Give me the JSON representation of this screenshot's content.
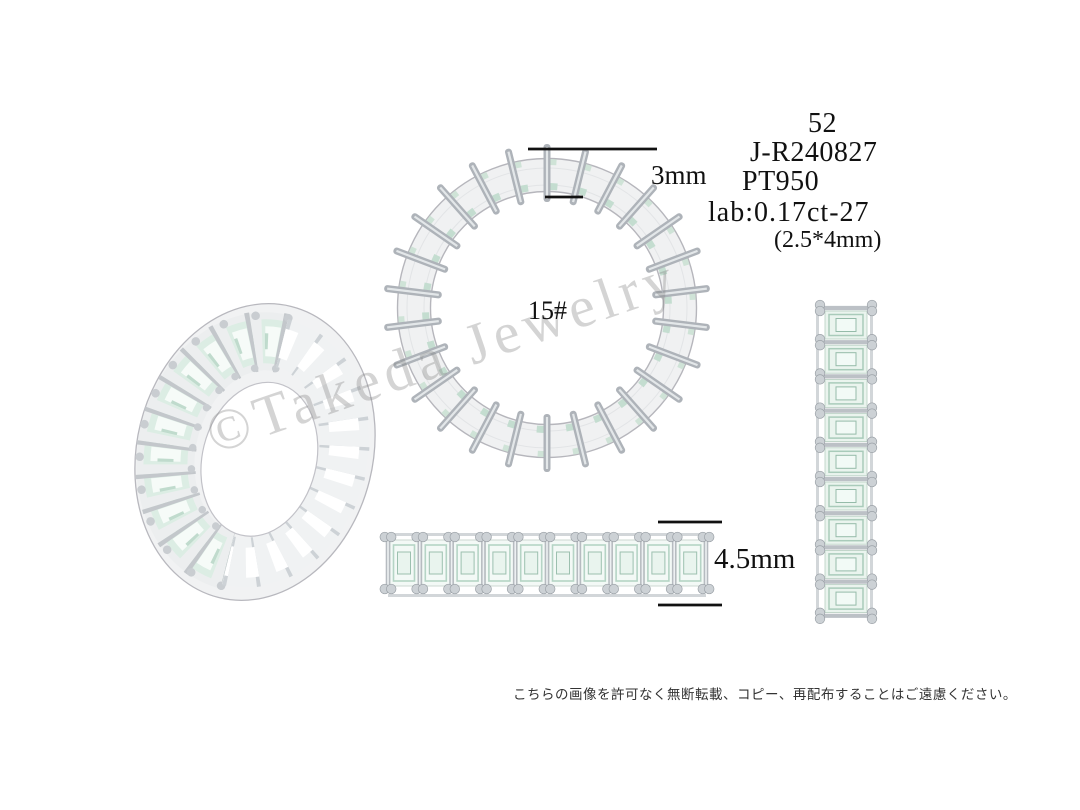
{
  "specs": {
    "size": "52",
    "model_number": "J-R240827",
    "metal": "PT950",
    "stone_spec": "lab:0.17ct-27",
    "stone_size": "(2.5*4mm)"
  },
  "dimensions": {
    "band_width": "3mm",
    "band_height": "4.5mm"
  },
  "ring": {
    "size_label": "15#"
  },
  "watermark": {
    "text": "©Takeda Jewelry",
    "color": "#c9c9c9"
  },
  "footer": {
    "disclaimer": "こちらの画像を許可なく無断転載、コピー、再配布することはご遠慮ください。"
  },
  "colors": {
    "metal_light": "#f1f2f3",
    "metal_mid": "#b4b8bd",
    "metal_outline": "#b6b6bc",
    "stone_mint": "#dceee4",
    "stone_facet": "#a9cbbb",
    "dimension_line": "#111111",
    "text": "#111111"
  }
}
